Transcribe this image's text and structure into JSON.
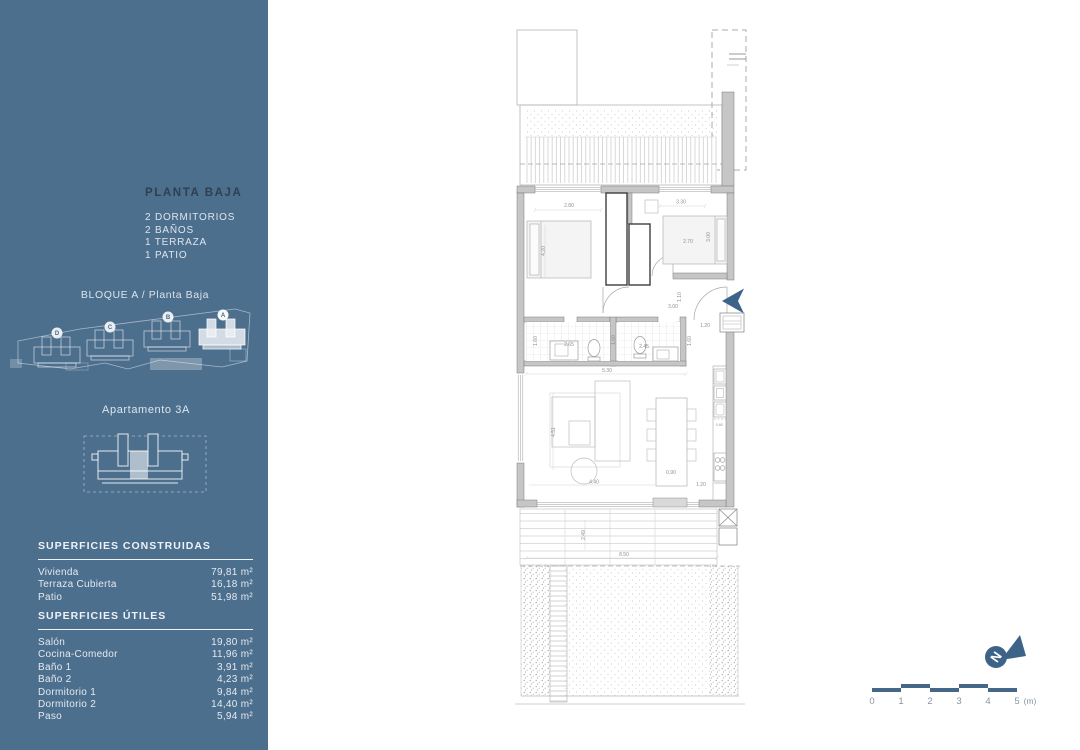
{
  "colors": {
    "sidebar_bg": "#4d6f8e",
    "title_dark": "#2d3f51",
    "sidebar_text": "#dde5ec",
    "accent_blue": "#3d6488",
    "scale_text": "#8995a5",
    "plan_dim_text": "#8f8f8f"
  },
  "sidebar": {
    "title": "PLANTA BAJA",
    "features": [
      "2 DORMITORIOS",
      "2 BAÑOS",
      "1 TERRAZA",
      "1 PATIO"
    ],
    "block_label": "BLOQUE A / Planta Baja",
    "site_blocks": [
      "D",
      "C",
      "B",
      "A"
    ],
    "apartment_label": "Apartamento 3A",
    "constructed": {
      "heading": "SUPERFICIES CONSTRUIDAS",
      "rows": [
        {
          "label": "Vivienda",
          "value": "79,81 m²"
        },
        {
          "label": "Terraza Cubierta",
          "value": "16,18 m²"
        },
        {
          "label": "Patio",
          "value": "51,98 m²"
        }
      ]
    },
    "useful": {
      "heading": "SUPERFICIES ÚTILES",
      "rows": [
        {
          "label": "Salón",
          "value": "19,80 m²"
        },
        {
          "label": "Cocina-Comedor",
          "value": "11,96 m²"
        },
        {
          "label": "Baño 1",
          "value": "3,91 m²"
        },
        {
          "label": "Baño 2",
          "value": "4,23 m²"
        },
        {
          "label": "Dormitorio 1",
          "value": "9,84 m²"
        },
        {
          "label": "Dormitorio 2",
          "value": "14,40 m²"
        },
        {
          "label": "Paso",
          "value": "5,94 m²"
        }
      ]
    }
  },
  "plan": {
    "dims": {
      "bedroom2_width": "2.80",
      "bedroom2_depth": "4.20",
      "bedroom1_top": "3.30",
      "bedroom1_width": "2.70",
      "bedroom1_depth": "3.00",
      "hall_height": "1.10",
      "hall_width": "3.00",
      "entry_planter": "1.20",
      "bath1_depth": "1.60",
      "bath1_width": "2.65",
      "bath2_depth": "1.60",
      "bath2_width": "2.45",
      "entry_depth": "1.60",
      "corridor_width": "5.30",
      "living_depth": "4.51",
      "living_width": "4.40",
      "dining_width": "0.90",
      "kitchen_front": "1.20",
      "counter_depth": "0.60",
      "deck_depth": "2.49",
      "deck_width": "8.50"
    }
  },
  "north_arrow": {
    "letter": "N"
  },
  "scale_bar": {
    "ticks": [
      "0",
      "1",
      "2",
      "3",
      "4",
      "5"
    ],
    "unit": "(m)"
  }
}
